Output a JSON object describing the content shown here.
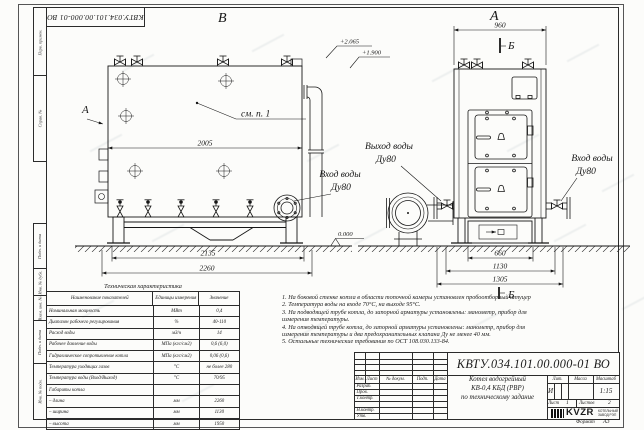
{
  "sheet": {
    "stamp_number": "КВТУ.034.101.00.000-01 ВО",
    "format_label": "Формат",
    "format_value": "А3"
  },
  "frame": {
    "perv_primen": "Перв. примен.",
    "sprav_no": "Справ. №",
    "podp_data1": "Подп. и дата",
    "inv_dubl": "Инв. № дубл.",
    "vzam_inv": "Взам. инв. №",
    "podp_data2": "Подп. и дата",
    "inv_podl": "Инв. № подл."
  },
  "views": {
    "left": {
      "label": "В",
      "side_view_arrow": "А",
      "callout": "см. п. 1",
      "inlet_line1": "Вход воды",
      "inlet_line2": "Ду80",
      "dim_body": "2005",
      "dim_support": "2135",
      "dim_total": "2260",
      "level_top": "+2.065",
      "level_mid": "+1.900",
      "level_zero": "0.000"
    },
    "front": {
      "label": "А",
      "section_mark": "Б",
      "section_label": "Б",
      "outlet_line1": "Выход воды",
      "outlet_line2": "Ду80",
      "inlet_line1": "Вход воды",
      "inlet_line2": "Ду80",
      "dim_top": "960",
      "dim_base": "660",
      "dim_mid": "1130",
      "dim_total": "1305"
    }
  },
  "spec_table": {
    "title": "Техническая характеристика",
    "headers": [
      "Наименование показателей",
      "Единицы измерения",
      "Значение"
    ],
    "rows": [
      [
        "Номинальная мощность",
        "МВт",
        "0,4"
      ],
      [
        "Диапазон рабочего регулирования",
        "%",
        "40-110"
      ],
      [
        "Расход воды",
        "м3/ч",
        "14"
      ],
      [
        "Рабочее давление воды",
        "МПа (кгс/см2)",
        "0,6 (6,0)"
      ],
      [
        "Гидравлическое сопротивление котла",
        "МПа (кгс/см2)",
        "0,06 (0,6)"
      ],
      [
        "Температура уходящих газов",
        "°С",
        "не более 280"
      ],
      [
        "Температура воды (Вход/Выход)",
        "°С",
        "70/95"
      ],
      [
        "Габариты котла",
        "",
        ""
      ],
      [
        "– длина",
        "мм",
        "2260"
      ],
      [
        "– ширина",
        "мм",
        "1130"
      ],
      [
        "– высота",
        "мм",
        "1950"
      ]
    ]
  },
  "notes": [
    "1.  На боковой стенке котла в области топочной камеры установлен пробоотборный штуцер",
    "2.  Температура воды на входе  70°С, на выходе  95°С.",
    "3.  На подводящей трубе котла, до запорной арматуры установлены:  манометр, прибор для",
    "измерения температуры.",
    "4.  На отводящей трубе котла, до запорной арматуры установлены:  манометр, прибор для",
    "измерения температуры и два предохранительных клапана  Ду не менее 40 мм.",
    "5.  Остальные технические требования по ОСТ  108.030.133-84."
  ],
  "title_block": {
    "doc_number": "КВТУ.034.101.00.000-01 ВО",
    "columns": [
      "Изм.",
      "Лист",
      "№ докум.",
      "Подп.",
      "Дата"
    ],
    "roles": [
      "Разраб.",
      "Пров.",
      "Т.контр.",
      "",
      "Н.контр.",
      "Утв."
    ],
    "product_line1": "Котел водогрейный",
    "product_line2": "КВ-0,4  КБД  (РВР)",
    "product_line3": "по техническому задание",
    "lit_label": "Лит.",
    "mass_label": "Масса",
    "scale_label": "Масштаб",
    "lit_value": "И",
    "scale_value": "1:15",
    "sheet_label": "Лист",
    "sheet_value": "1",
    "sheets_label": "Листов",
    "sheets_value": "2",
    "logo_text": "KVZR",
    "logo_caption1": "КОТЕЛЬНЫЙ",
    "logo_caption2": "ЗАВОД РЭП"
  }
}
